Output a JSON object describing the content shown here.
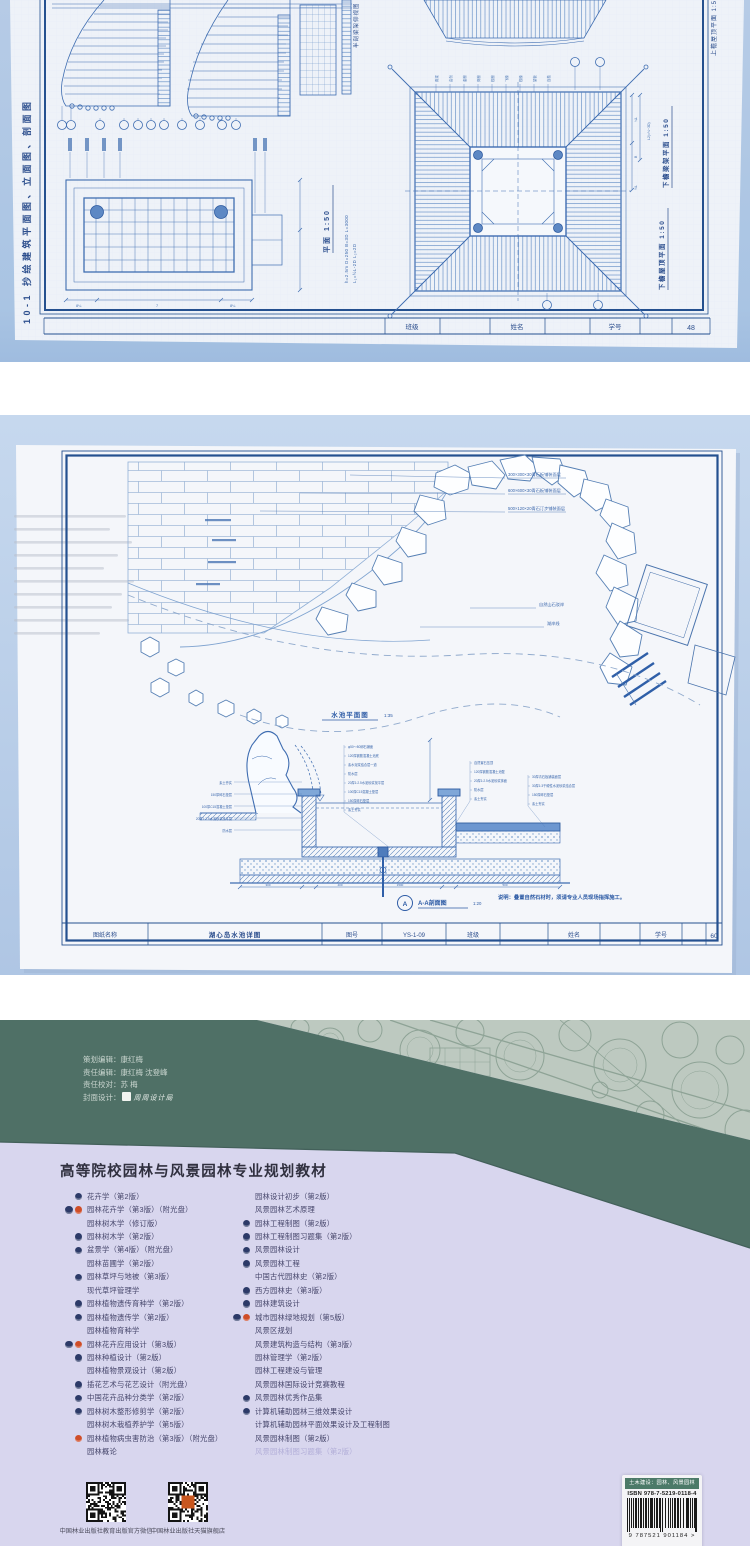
{
  "photo1": {
    "side_title": "10-1  抄绘建筑平面图、立面图、剖面图",
    "half_section_label": "半剖梁架仰视图",
    "plan_label": "平面  1:50",
    "note1": "h=2.5m  D=250  B=3D  L=3000",
    "note2": "L₁=½L-2D   L₂=2D",
    "upper_roof_label": "上檐屋顶平面  1:50",
    "beam_plan_label": "下檐梁架平面  1:50",
    "lower_roof_label": "下檐屋顶平面  1:50",
    "rafter_labels": [
      "角梁",
      "由戗",
      "金檩",
      "脊檩",
      "檐檩",
      "飞椽",
      "檐椽",
      "望板",
      "连檐"
    ],
    "dim_labels": [
      "L2(=⅓~3D)",
      "¼L",
      "B",
      "½L"
    ],
    "plan_dims": [
      "8¼",
      "7",
      "8¼"
    ],
    "titlebar": {
      "class_label": "班级",
      "name_label": "姓名",
      "id_label": "学号",
      "page": "48"
    }
  },
  "photo2": {
    "paving_notes": [
      "300×300×30青石板铺装面层",
      "600×600×30青石板铺装面层",
      "500×120×20青石汀步铺装面层"
    ],
    "shore_notes": [
      "自然山石驳岸",
      "湖岸线"
    ],
    "plan_title": "水池平面图",
    "plan_scale": "1:35",
    "callouts_left": [
      "素土夯实",
      "150厚碎石垫层",
      "100厚C15混凝土垫层",
      "20厚1:2.5水泥砂浆找平层",
      "防水层"
    ],
    "callouts_mid": [
      "φ50～80卵石铺面",
      "120厚钢筋混凝土池底",
      "素水泥浆结合层一道",
      "防水层",
      "20厚1:2.5水泥砂浆找平层",
      "100厚C15混凝土垫层",
      "150厚碎石垫层",
      "素土夯实"
    ],
    "callouts_right": [
      "自然置石压顶",
      "120厚钢筋混凝土池壁",
      "20厚1:2.5水泥砂浆抹面",
      "防水层",
      "素土夯实"
    ],
    "callouts_far": [
      "30厚青石板铺装面层",
      "30厚1:3干硬性水泥砂浆结合层",
      "150厚碎石垫层",
      "素土夯实"
    ],
    "section_dims": [
      "300",
      "400",
      "1500",
      "500"
    ],
    "section_marker": "A",
    "section_title": "A-A剖面图",
    "section_scale": "1:20",
    "note": "说明：叠置自然石材时，须请专业人员现场指挥施工。",
    "titleblock": {
      "sheet_label": "图纸名称",
      "sheet": "湖心岛水池详图",
      "no_label": "图号",
      "no": "YS-1-09",
      "class_label": "班级",
      "name_label": "姓名",
      "id_label": "学号",
      "page": "60"
    }
  },
  "cover": {
    "credits": [
      {
        "label": "策划编辑：",
        "value": "康红梅"
      },
      {
        "label": "责任编辑：",
        "value": "康红梅  沈登峰"
      },
      {
        "label": "责任校对：",
        "value": "苏  梅"
      },
      {
        "label": "封面设计：",
        "value": "周周设计局"
      }
    ],
    "series_title": "高等院校园林与风景园林专业规划教材",
    "books_left": [
      {
        "t": "花卉学（第2版）",
        "i": "t"
      },
      {
        "t": "园林花卉学（第3版）（附光盘）",
        "i": "tr"
      },
      {
        "t": "园林树木学（修订版）",
        "i": ""
      },
      {
        "t": "园林树木学（第2版）",
        "i": "t"
      },
      {
        "t": "盆景学（第4版）（附光盘）",
        "i": "t"
      },
      {
        "t": "园林苗圃学（第2版）",
        "i": ""
      },
      {
        "t": "园林草坪与地被（第3版）",
        "i": "t"
      },
      {
        "t": "现代草坪管理学",
        "i": ""
      },
      {
        "t": "园林植物遗传育种学（第2版）",
        "i": "t"
      },
      {
        "t": "园林植物遗传学（第2版）",
        "i": "t"
      },
      {
        "t": "园林植物育种学",
        "i": ""
      },
      {
        "t": "园林花卉应用设计（第3版）",
        "i": "tr"
      },
      {
        "t": "园林种植设计（第2版）",
        "i": "t"
      },
      {
        "t": "园林植物景观设计（第2版）",
        "i": ""
      },
      {
        "t": "插花艺术与花艺设计（附光盘）",
        "i": "t"
      },
      {
        "t": "中国花卉品种分类学（第2版）",
        "i": "t"
      },
      {
        "t": "园林树木整形修剪学（第2版）",
        "i": "t"
      },
      {
        "t": "园林树木栽植养护学（第5版）",
        "i": ""
      },
      {
        "t": "园林植物病虫害防治（第3版）（附光盘）",
        "i": "r"
      },
      {
        "t": "园林概论",
        "i": ""
      }
    ],
    "books_right": [
      {
        "t": "园林设计初步（第2版）",
        "i": ""
      },
      {
        "t": "风景园林艺术原理",
        "i": ""
      },
      {
        "t": "园林工程制图（第2版）",
        "i": "t"
      },
      {
        "t": "园林工程制图习题集（第2版）",
        "i": "t"
      },
      {
        "t": "风景园林设计",
        "i": "t"
      },
      {
        "t": "风景园林工程",
        "i": "t"
      },
      {
        "t": "中国古代园林史（第2版）",
        "i": ""
      },
      {
        "t": "西方园林史（第3版）",
        "i": "t"
      },
      {
        "t": "园林建筑设计",
        "i": "t"
      },
      {
        "t": "城市园林绿地规划（第5版）",
        "i": "tr"
      },
      {
        "t": "风景区规划",
        "i": ""
      },
      {
        "t": "风景建筑构造与结构（第3版）",
        "i": ""
      },
      {
        "t": "园林管理学（第2版）",
        "i": ""
      },
      {
        "t": "园林工程建设与管理",
        "i": ""
      },
      {
        "t": "风景园林国际设计竞赛教程",
        "i": ""
      },
      {
        "t": "风景园林优秀作品集",
        "i": "t"
      },
      {
        "t": "计算机辅助园林三维效果设计",
        "i": "t"
      },
      {
        "t": "计算机辅助园林平面效果设计及工程制图",
        "i": ""
      },
      {
        "t": "风景园林制图（第2版）",
        "i": ""
      },
      {
        "t": "风景园林制图习题集（第2版）",
        "i": "",
        "f": true
      }
    ],
    "qr_captions": [
      "中国林业出版社教育出版官方微信",
      "中国林业出版社天猫旗舰店"
    ],
    "barcode": {
      "category": "土木建设：园林、风景园林",
      "isbn": "ISBN 978-7-5219-0118-4",
      "digits": "9 787521 901184 >"
    }
  },
  "colors": {
    "blueprint_line": "#3f6db1",
    "blueprint_frame": "#24508f",
    "photo_backdrop": "#b3c8e5",
    "cover_green": "#4f7066",
    "cover_pattern_bg": "#bdc9c0",
    "cover_lavender": "#d8d6ee",
    "badge_navy": "#2c3a68",
    "badge_red": "#cf4d28"
  }
}
